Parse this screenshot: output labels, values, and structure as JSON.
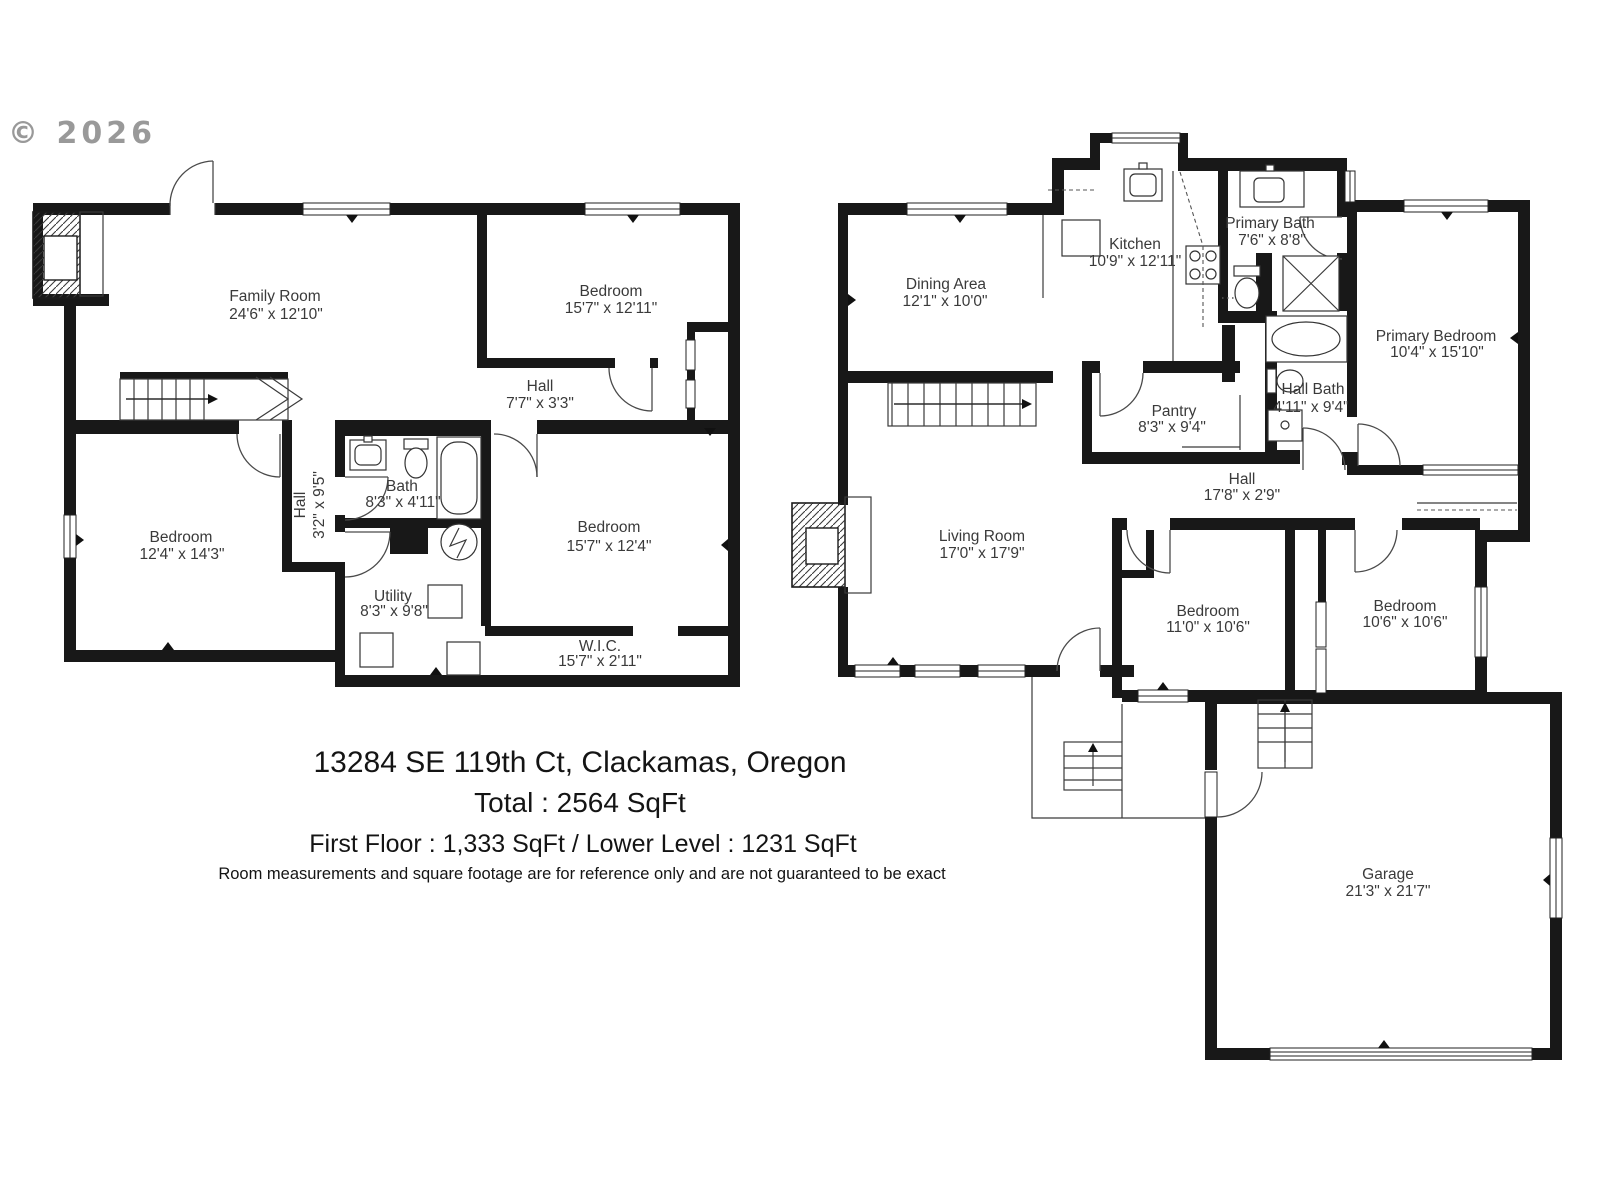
{
  "copyright": "© 2026",
  "footer": {
    "address": "13284 SE 119th Ct, Clackamas, Oregon",
    "total": "Total : 2564 SqFt",
    "floors": "First Floor : 1,333 SqFt / Lower Level : 1231 SqFt",
    "disclaimer": "Room measurements and square footage are for reference only and are not guaranteed to be exact"
  },
  "colors": {
    "walls": "#181818",
    "background": "#ffffff",
    "label_text": "#3a3a3a",
    "copyright_text": "#8f8f8f"
  },
  "lower_level": {
    "rooms": [
      {
        "name": "Family Room",
        "dims": "24'6\" x 12'10\""
      },
      {
        "name": "Bedroom",
        "dims": "15'7\" x 12'11\""
      },
      {
        "name": "Hall",
        "dims": "7'7\" x 3'3\""
      },
      {
        "name": "Bedroom",
        "dims": "12'4\" x 14'3\""
      },
      {
        "name": "Hall",
        "dims": "3'2\" x 9'5\""
      },
      {
        "name": "Bath",
        "dims": "8'3\" x 4'11\""
      },
      {
        "name": "Bedroom",
        "dims": "15'7\" x 12'4\""
      },
      {
        "name": "Utility",
        "dims": "8'3\" x 9'8\""
      },
      {
        "name": "W.I.C.",
        "dims": "15'7\" x 2'11\""
      }
    ]
  },
  "first_floor": {
    "rooms": [
      {
        "name": "Dining Area",
        "dims": "12'1\" x 10'0\""
      },
      {
        "name": "Kitchen",
        "dims": "10'9\" x 12'11\""
      },
      {
        "name": "Primary Bath",
        "dims": "7'6\" x 8'8\""
      },
      {
        "name": "Primary Bedroom",
        "dims": "10'4\" x 15'10\""
      },
      {
        "name": "Pantry",
        "dims": "8'3\" x 9'4\""
      },
      {
        "name": "Hall Bath",
        "dims": "4'11\" x 9'4\""
      },
      {
        "name": "Hall",
        "dims": "17'8\" x 2'9\""
      },
      {
        "name": "Living Room",
        "dims": "17'0\" x 17'9\""
      },
      {
        "name": "Bedroom",
        "dims": "11'0\" x 10'6\""
      },
      {
        "name": "Bedroom",
        "dims": "10'6\" x 10'6\""
      },
      {
        "name": "Garage",
        "dims": "21'3\" x 21'7\""
      }
    ]
  }
}
